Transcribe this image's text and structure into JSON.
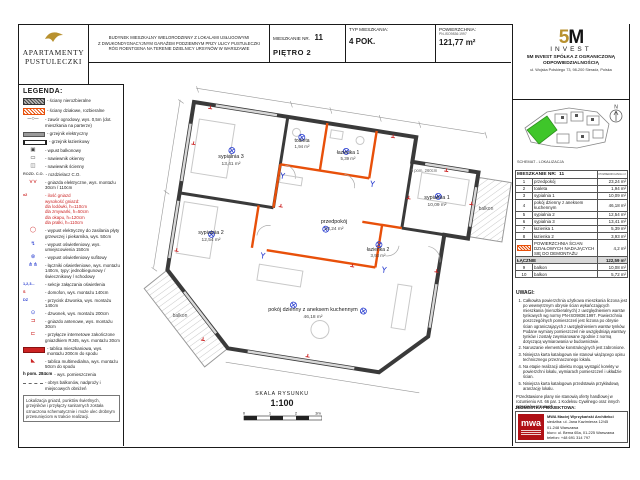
{
  "header": {
    "brand_line1": "APARTAMENTY",
    "brand_line2": "PUSTULECZKI",
    "description_lines": [
      "BUDYNEK MIESZKALNY WIELORODZINNY Z LOKALAMI USŁUGOWYMI",
      "Z DWUKONDYGNACYJNYM GARAŻEM PODZIEMNYM PRZY ULICY PUSTUŁECZKI",
      "RÓG ROENTGENA NA TERENIE DZIELNICY URSYNÓW W WARSZAWIE"
    ],
    "apartment_label": "MIESZKANIE NR.",
    "apartment_number": "11",
    "floor_label": "PIĘTRO",
    "floor_number": "2",
    "type_label": "TYP MIESZKANIA:",
    "type_value": "4 POK.",
    "area_label": "POWIERZCHNIA:",
    "area_norm": "PN-ISO9836:1997",
    "area_value": "121,77 m²"
  },
  "developer": {
    "logo_5": "5",
    "logo_m": "M",
    "logo_invest": "INVEST",
    "name_line1": "5M INVEST  SPÓŁKA Z OGRANICZONĄ",
    "name_line2": "ODPOWIEDZIALNOŚCIĄ",
    "address": "ul. Wojska Polskiego 73, 98-200 Sieradz, Polska"
  },
  "location_map": {
    "caption": "SCHEMAT - LOKALIZACJA",
    "north_label": "N"
  },
  "room_table": {
    "title_label": "MIESZKANIE NR:",
    "title_number": "11",
    "area_header": "POWIERZCHNIA m²",
    "rows": [
      {
        "no": "1",
        "name": "przedpokój",
        "area": "23,24 m²"
      },
      {
        "no": "2",
        "name": "toaleta",
        "area": "1,94 m²"
      },
      {
        "no": "3",
        "name": "sypialnia 1",
        "area": "10,09 m²"
      },
      {
        "no": "4",
        "name": "pokój dzienny z aneksem kuchennym",
        "area": "46,18 m²"
      },
      {
        "no": "5",
        "name": "sypialnia 2",
        "area": "12,54 m²"
      },
      {
        "no": "6",
        "name": "sypialnia 3",
        "area": "13,41 m²"
      },
      {
        "no": "7",
        "name": "łazienka 1",
        "area": "5,39 m²"
      },
      {
        "no": "8",
        "name": "łazienka 2",
        "area": "3,93 m²"
      }
    ],
    "demolition_row": {
      "name": "POWIERZCHNIA ŚCIAN DZIAŁOWYCH NADAJĄCYCH SIĘ DO DEMONTAŻU",
      "area": "4,2 m²"
    },
    "total_row": {
      "label": "ŁĄCZNIE",
      "area": "122,59 m²"
    },
    "balcony_rows": [
      {
        "no": "9",
        "name": "balkon",
        "area": "10,08 m²"
      },
      {
        "no": "10",
        "name": "balkon",
        "area": "5,72 m²"
      }
    ]
  },
  "legend": {
    "title": "LEGENDA:",
    "items": [
      {
        "text": "- ściany nierozbieralne"
      },
      {
        "text": "- ściany działowe, rozbieralne"
      },
      {
        "text": "- zawór ogrodowy, wys. 0,5m (dot. mieszkania na parterze)"
      },
      {
        "text": "- grzejnik elektryczny"
      },
      {
        "text": "- grzejnik łazienkowy"
      },
      {
        "text": "- wpust balkonowy"
      },
      {
        "text": "- nawiewnik okienny"
      },
      {
        "text": "- nawiewnik ścienny"
      },
      {
        "icon_label": "ROZD. C.O.",
        "text": "- rozdzielacz C.O."
      },
      {
        "text": "- gniazda elektryczne, wys. montażu 30cm / 110cm"
      },
      {
        "icon_label": "x2",
        "text": "- ilość gniazd\nwysokość gniazd:\ndla lodówki, h=110cm\ndla zmywarki, h=50cm\ndla okapu, h=120cm\ndla pralki, h=110cm"
      },
      {
        "text": "- wypust elektryczny do zasilania płyty grzewczej i piekarnika, wys. 50cm"
      },
      {
        "text": "- wypust oświetleniowy, wys. umiejscowienia 150cm"
      },
      {
        "text": "- wypust oświetleniowy sufitowy"
      },
      {
        "text": "- łączniki oświetleniowe, wys. montażu 140cm, typy: jednobiegunowy / świecznikowy / schodowy"
      },
      {
        "icon_label": "1,2,3...",
        "text": "- sekcje załączania oświetlenia"
      },
      {
        "icon_label": "S",
        "text": "- domofon, wys. montażu 140cm"
      },
      {
        "icon_label": "DZ",
        "text": "- przycisk dzwonka, wys. montażu 140cm"
      },
      {
        "text": "- dzwonek, wys. montażu 200cm"
      },
      {
        "text": "- gniazdo antenowe, wys. montażu 30cm"
      },
      {
        "text": "- przyłącze internetowe zakończone gniazdkiem RJ45, wys. montażu 30cm"
      },
      {
        "text": "- tablica mieszkaniowa, wys. montażu 200cm do spodu"
      },
      {
        "text": "- tablica multimedialna, wys. montażu 50cm do spodu"
      },
      {
        "icon_label": "h pom. 284cm",
        "text": "- wys.  pomieszczenia"
      },
      {
        "text": "- obrys balkonów, nadproży i miejscowych obniżeń"
      }
    ],
    "footnote": "Lokalizacja gniazd, punktów świetlnych, grzejników i przyłączy sanitarnych została oznaczona schematycznie i może ulec drobnym przesunięciom w trakcie realizacji."
  },
  "plan": {
    "rooms": [
      {
        "name": "sypialnia 3",
        "area": "13,41 m²"
      },
      {
        "name": "toaleta",
        "area": "1,94 m²"
      },
      {
        "name": "łazienka 1",
        "area": "5,39 m²"
      },
      {
        "name": "sypialnia 1",
        "area": "10,09 m²"
      },
      {
        "name": "sypialnia 2",
        "area": "12,54 m²"
      },
      {
        "name": "przedpokój",
        "area": "23,24 m²"
      },
      {
        "name": "łazienka 2",
        "area": "3,93 m²"
      },
      {
        "name": "pokój dzienny z aneksem kuchennym",
        "area": "46,18 m²"
      },
      {
        "name": "balkon",
        "area": ""
      },
      {
        "name": "balkon",
        "area": ""
      }
    ],
    "height_note": "h pom. 260cm"
  },
  "scale_block": {
    "caption": "SKALA RYSUNKU",
    "value": "1:100",
    "ticks": [
      "0",
      "1",
      "2",
      "3m"
    ]
  },
  "notes": {
    "title": "UWAGI:",
    "items": [
      "Całkowita powierzchnia użytkowa mieszkania liczona jest po wewnętrznym obrysie ścian wykańczających mieszkania (nierozbieralnych) z uwzględnieniem warstw tynkowych wg normy PN-ISO9836:1997. Powierzchnia poszczególnych pomieszczeń jest liczona po obrysie ścian ograniczających z uwzględnieniem warstw tynków. Podane wymiary pomieszczeń nie uwzględniają warstwy tynków i zostały zwymiarowane zgodnie z normą dotyczącą wymiarowania w budownictwie.",
      "Naruszanie elementów konstrukcyjnych jest zabronione.",
      "Niniejsza karta katalogowa nie stanowi wiążącego opisu technicznego przeznaczonego lokalu.",
      "Na etapie realizacji obiektu mogą wystąpić korekty w powierzchni lokalu, wymiarach pomieszczeń i układzie ścian.",
      "Niniejsza karta katalogowa przedstawia przykładową aranżację lokalu."
    ],
    "disclaimer": "Przedstawione plany nie stanowią oferty handlowej w rozumieniu Art. 66 par. 1 Kodeksu Cywilnego oraz innych przepisów prawnych."
  },
  "design_office": {
    "title": "JEDNOSTKA PROJEKTOWA:",
    "logo_text": "mwa",
    "name": "MWA Maciej Wyrzykański Architekci",
    "line1": "siedziba: ul. Jana Kazimierza 12/45",
    "line2": "01-248 Warszawa",
    "line3": "biuro: ul. Bema 65a, 01-225 Warszawa",
    "phone": "telefon: +48 691 314 797"
  },
  "colors": {
    "wall_dark": "#3a3a3a",
    "partition_orange": "#e8500a",
    "electric_blue": "#2b3fd0",
    "electric_red": "#cc2222",
    "brand_gold": "#b8912f",
    "map_green": "#3fc62a",
    "office_logo_red": "#b01116",
    "total_row_gray": "#d9d9d9"
  }
}
